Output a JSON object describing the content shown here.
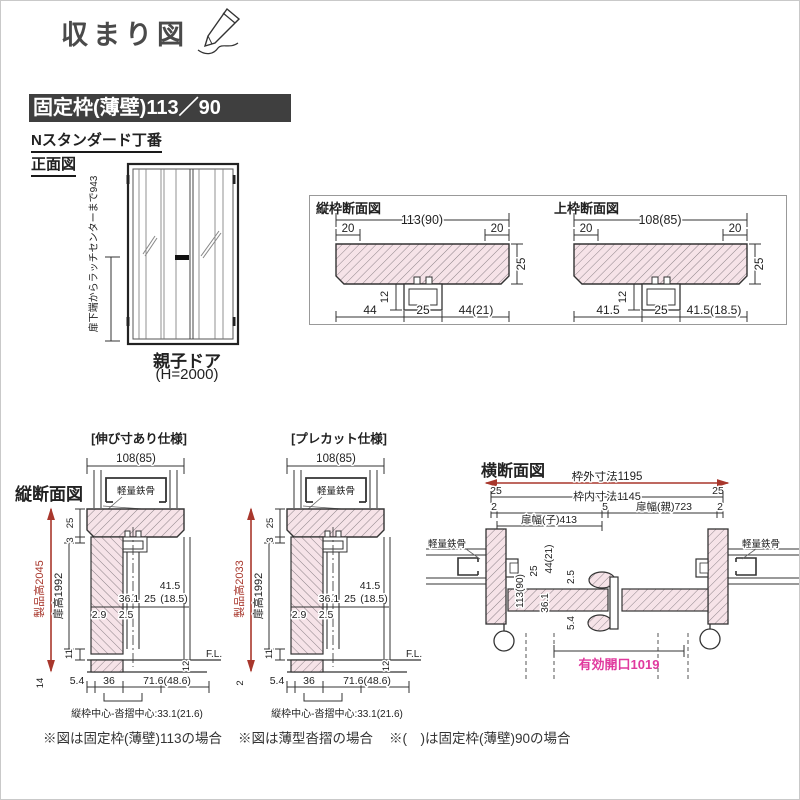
{
  "title": "収まり図",
  "header": {
    "product": "固定枠(薄壁)113／90",
    "hinge": "Nスタンダード丁番"
  },
  "front": {
    "label": "正面図",
    "latch_dim": "扉下端からラッチセンターまで943",
    "caption": "親子ドア",
    "caption_sub": "(H=2000)"
  },
  "frame_sections": {
    "vertical": {
      "title": "縦枠断面図",
      "width": "113(90)",
      "edge_l": "20",
      "edge_r": "20",
      "height": "25",
      "groove": "12",
      "b1": "44",
      "b2": "25",
      "b3": "44(21)"
    },
    "top": {
      "title": "上枠断面図",
      "width": "108(85)",
      "edge_l": "20",
      "edge_r": "20",
      "height": "25",
      "groove": "12",
      "b1": "41.5",
      "b2": "25",
      "b3": "41.5(18.5)"
    }
  },
  "vertical_section": {
    "label": "縦断面図",
    "d1": {
      "caption": "[伸び寸あり仕様]",
      "width": "108(85)",
      "steel": "軽量鉄骨",
      "head": "25",
      "gap": "3",
      "product_h": "製品高2045",
      "door_h": "扉高1992",
      "a1": "41.5",
      "a2": "36.1",
      "a3": "25",
      "a4": "(18.5)",
      "a5": "2.9",
      "a6": "2.5",
      "b1": "11",
      "b2": "14",
      "c1": "5.4",
      "c2": "36",
      "c3": "71.6(48.6)",
      "c4": "12",
      "fl": "F.L.",
      "note": "縦枠中心-沓摺中心:33.1(21.6)"
    },
    "d2": {
      "caption": "[プレカット仕様]",
      "width": "108(85)",
      "steel": "軽量鉄骨",
      "head": "25",
      "gap": "3",
      "product_h": "製品高2033",
      "door_h": "扉高1992",
      "a1": "41.5",
      "a2": "36.1",
      "a3": "25",
      "a4": "(18.5)",
      "a5": "2.9",
      "a6": "2.5",
      "b1": "11",
      "b2": "2",
      "c1": "5.4",
      "c2": "36",
      "c3": "71.6(48.6)",
      "c4": "12",
      "fl": "F.L.",
      "note": "縦枠中心-沓摺中心:33.1(21.6)"
    }
  },
  "horizontal_section": {
    "label": "横断面図",
    "outer_dim": "枠外寸法1195",
    "inner_dim": "枠内寸法1145",
    "end_l": "25",
    "end_r": "25",
    "gap_l": "2",
    "gap_mid": "5",
    "parent_w": "扉幅(親)723",
    "gap_r": "2",
    "child_w": "扉幅(子)413",
    "steel_l": "軽量鉄骨",
    "steel_r": "軽量鉄骨",
    "jamb": "113(90)",
    "v1": "44(21)",
    "v2": "25",
    "v3": "36.1",
    "v4": "2.5",
    "v5": "5.4",
    "opening": "有効開口1019"
  },
  "notes": {
    "n1": "※図は固定枠(薄壁)113の場合",
    "n2": "※図は薄型沓摺の場合",
    "n3": "※(　)は固定枠(薄壁)90の場合"
  },
  "colors": {
    "red": "#a8372c",
    "magenta": "#e0399e",
    "bar_bg": "#3f3f3f",
    "hatch_fill": "#f6e3e8",
    "line": "#2b2b2b"
  }
}
